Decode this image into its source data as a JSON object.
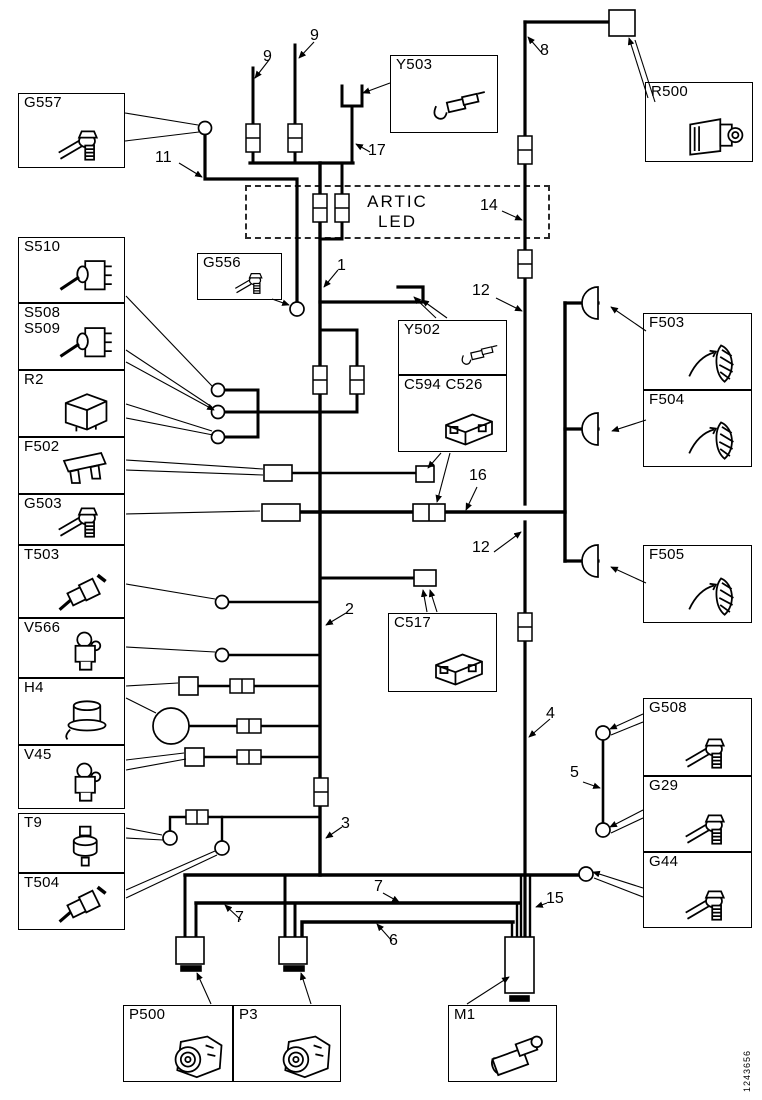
{
  "diagram": {
    "kind": "wiring-diagram",
    "note_box": {
      "lines": [
        "ARTIC",
        "LED"
      ]
    },
    "part_number": "1243656",
    "components": [
      {
        "id": "G557",
        "label_lines": [
          "G557"
        ],
        "icon": "ground-terminal",
        "x": 18,
        "y": 93,
        "w": 107,
        "h": 75
      },
      {
        "id": "S510",
        "label_lines": [
          "S510"
        ],
        "icon": "toggle-switch",
        "x": 18,
        "y": 237,
        "w": 107,
        "h": 66
      },
      {
        "id": "S508 S509",
        "label_lines": [
          "S508",
          "S509"
        ],
        "icon": "toggle-switch",
        "x": 18,
        "y": 303,
        "w": 107,
        "h": 67
      },
      {
        "id": "R2",
        "label_lines": [
          "R2"
        ],
        "icon": "relay",
        "x": 18,
        "y": 370,
        "w": 107,
        "h": 67
      },
      {
        "id": "F502",
        "label_lines": [
          "F502"
        ],
        "icon": "fuse",
        "x": 18,
        "y": 437,
        "w": 107,
        "h": 57
      },
      {
        "id": "G503",
        "label_lines": [
          "G503"
        ],
        "icon": "ground-terminal",
        "x": 18,
        "y": 494,
        "w": 107,
        "h": 51
      },
      {
        "id": "T503",
        "label_lines": [
          "T503"
        ],
        "icon": "temp-sensor",
        "x": 18,
        "y": 545,
        "w": 107,
        "h": 73
      },
      {
        "id": "V566",
        "label_lines": [
          "V566"
        ],
        "icon": "valve",
        "x": 18,
        "y": 618,
        "w": 107,
        "h": 60
      },
      {
        "id": "H4",
        "label_lines": [
          "H4"
        ],
        "icon": "horn",
        "x": 18,
        "y": 678,
        "w": 107,
        "h": 67
      },
      {
        "id": "V45",
        "label_lines": [
          "V45"
        ],
        "icon": "valve",
        "x": 18,
        "y": 745,
        "w": 107,
        "h": 64
      },
      {
        "id": "T9",
        "label_lines": [
          "T9"
        ],
        "icon": "pressure-sensor",
        "x": 18,
        "y": 813,
        "w": 107,
        "h": 60
      },
      {
        "id": "T504",
        "label_lines": [
          "T504"
        ],
        "icon": "temp-sensor",
        "x": 18,
        "y": 873,
        "w": 107,
        "h": 57
      },
      {
        "id": "Y503",
        "label_lines": [
          "Y503"
        ],
        "icon": "connector-pin",
        "x": 390,
        "y": 55,
        "w": 108,
        "h": 78
      },
      {
        "id": "R500",
        "label_lines": [
          "R500"
        ],
        "icon": "relay-large",
        "x": 645,
        "y": 82,
        "w": 108,
        "h": 80
      },
      {
        "id": "G556",
        "label_lines": [
          "G556"
        ],
        "icon": "ground-terminal",
        "x": 197,
        "y": 253,
        "w": 85,
        "h": 47,
        "small": true
      },
      {
        "id": "Y502",
        "label_lines": [
          "Y502"
        ],
        "icon": "connector-pin",
        "x": 398,
        "y": 320,
        "w": 109,
        "h": 55,
        "small": true
      },
      {
        "id": "C594 C526",
        "label_lines": [
          "C594 C526"
        ],
        "icon": "connector-housing",
        "x": 398,
        "y": 375,
        "w": 109,
        "h": 77
      },
      {
        "id": "F503",
        "label_lines": [
          "F503"
        ],
        "icon": "lamp",
        "x": 643,
        "y": 313,
        "w": 109,
        "h": 77
      },
      {
        "id": "F504",
        "label_lines": [
          "F504"
        ],
        "icon": "lamp",
        "x": 643,
        "y": 390,
        "w": 109,
        "h": 77
      },
      {
        "id": "F505",
        "label_lines": [
          "F505"
        ],
        "icon": "lamp",
        "x": 643,
        "y": 545,
        "w": 109,
        "h": 78
      },
      {
        "id": "C517",
        "label_lines": [
          "C517"
        ],
        "icon": "connector-housing",
        "x": 388,
        "y": 613,
        "w": 109,
        "h": 79
      },
      {
        "id": "G508",
        "label_lines": [
          "G508"
        ],
        "icon": "ground-terminal",
        "x": 643,
        "y": 698,
        "w": 109,
        "h": 78
      },
      {
        "id": "G29",
        "label_lines": [
          "G29"
        ],
        "icon": "ground-terminal",
        "x": 643,
        "y": 776,
        "w": 109,
        "h": 76
      },
      {
        "id": "G44",
        "label_lines": [
          "G44"
        ],
        "icon": "ground-terminal",
        "x": 643,
        "y": 852,
        "w": 109,
        "h": 76
      },
      {
        "id": "P500",
        "label_lines": [
          "P500"
        ],
        "icon": "alternator",
        "x": 123,
        "y": 1005,
        "w": 110,
        "h": 77
      },
      {
        "id": "P3",
        "label_lines": [
          "P3"
        ],
        "icon": "alternator",
        "x": 233,
        "y": 1005,
        "w": 108,
        "h": 77
      },
      {
        "id": "M1",
        "label_lines": [
          "M1"
        ],
        "icon": "starter-motor",
        "x": 448,
        "y": 1005,
        "w": 109,
        "h": 77
      }
    ],
    "wire_labels": [
      {
        "text": "9",
        "x": 263,
        "y": 49
      },
      {
        "text": "9",
        "x": 310,
        "y": 28
      },
      {
        "text": "17",
        "x": 368,
        "y": 143
      },
      {
        "text": "8",
        "x": 540,
        "y": 43
      },
      {
        "text": "11",
        "x": 155,
        "y": 150
      },
      {
        "text": "14",
        "x": 480,
        "y": 198
      },
      {
        "text": "1",
        "x": 337,
        "y": 258
      },
      {
        "text": "12",
        "x": 472,
        "y": 283
      },
      {
        "text": "16",
        "x": 469,
        "y": 468
      },
      {
        "text": "12",
        "x": 472,
        "y": 540
      },
      {
        "text": "2",
        "x": 345,
        "y": 602
      },
      {
        "text": "4",
        "x": 546,
        "y": 706
      },
      {
        "text": "5",
        "x": 570,
        "y": 765
      },
      {
        "text": "3",
        "x": 341,
        "y": 816
      },
      {
        "text": "7",
        "x": 235,
        "y": 910
      },
      {
        "text": "7",
        "x": 374,
        "y": 879
      },
      {
        "text": "6",
        "x": 389,
        "y": 933
      },
      {
        "text": "15",
        "x": 546,
        "y": 891
      }
    ]
  }
}
